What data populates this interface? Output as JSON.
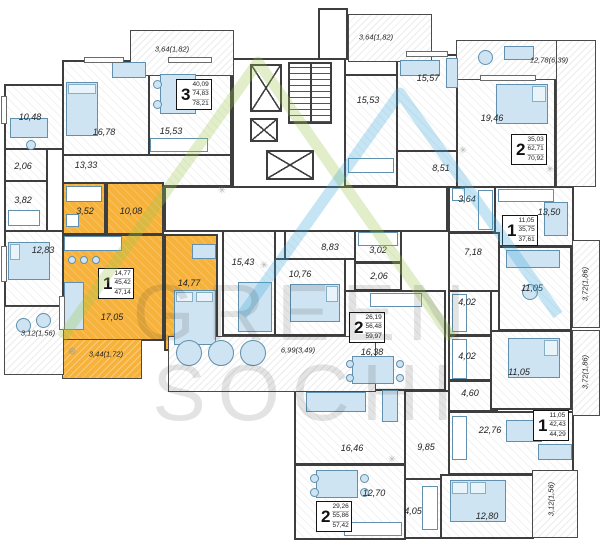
{
  "watermark": {
    "line1": "GREEN",
    "line2": "SOCHI"
  },
  "colors": {
    "highlight": "#f6b23a",
    "wall": "#3e3e3e",
    "logo_green": "#9dc84b",
    "logo_blue": "#3fa9dc",
    "furniture": "#cfe4f2"
  },
  "icons": {
    "snowflake": "✳",
    "plant": "❆"
  },
  "apartments": [
    {
      "rooms": "3",
      "area_living": "40,09",
      "area_no_balcony": "74,83",
      "area_total": "78,21"
    },
    {
      "rooms": "2",
      "area_living": "35,03",
      "area_no_balcony": "62,71",
      "area_total": "70,92"
    },
    {
      "rooms": "1",
      "area_living": "11,05",
      "area_no_balcony": "35,75",
      "area_total": "37,61"
    },
    {
      "rooms": "1",
      "area_living": "14,77",
      "area_no_balcony": "45,42",
      "area_total": "47,14"
    },
    {
      "rooms": "2",
      "area_living": "26,19",
      "area_no_balcony": "56,48",
      "area_total": "59,97"
    },
    {
      "rooms": "1",
      "area_living": "11,05",
      "area_no_balcony": "42,43",
      "area_total": "44,29"
    },
    {
      "rooms": "2",
      "area_living": "29,26",
      "area_no_balcony": "55,86",
      "area_total": "57,42"
    }
  ],
  "labels": {
    "r1048": "10,48",
    "r1678": "16,78",
    "r1553l": "15,53",
    "r1333": "13,33",
    "r206": "2,06",
    "r382": "3,82",
    "r1283": "12,83",
    "b312a": "3,12(1,56)",
    "b364l": "3,64(1,82)",
    "b364r": "3,64(1,82)",
    "r1553r": "15,53",
    "r1557": "15,57",
    "r1946": "19,46",
    "b1278": "12,78(6,39)",
    "r851": "8,51",
    "r364": "3,64",
    "r1350": "13,50",
    "r718": "7,18",
    "r1105a": "11,05",
    "b372a": "3,72(1,86)",
    "r402a": "4,02",
    "r402b": "4,02",
    "r1105b": "11,05",
    "b372b": "3,72(1,86)",
    "y352": "3,52",
    "y1008": "10,08",
    "y1705": "17,05",
    "y1477": "14,77",
    "yb344": "3,44(1,72)",
    "r1543": "15,43",
    "r883": "8,83",
    "r302": "3,02",
    "r206b": "2,06",
    "r1076": "10,76",
    "r1638": "16,38",
    "b699": "6,99(3,49)",
    "r460": "4,60",
    "r2276": "22,76",
    "r985": "9,85",
    "r1280": "12,80",
    "b312b": "3,12(1,56)",
    "r1646": "16,46",
    "r1270": "12,70",
    "r405": "4,05"
  }
}
